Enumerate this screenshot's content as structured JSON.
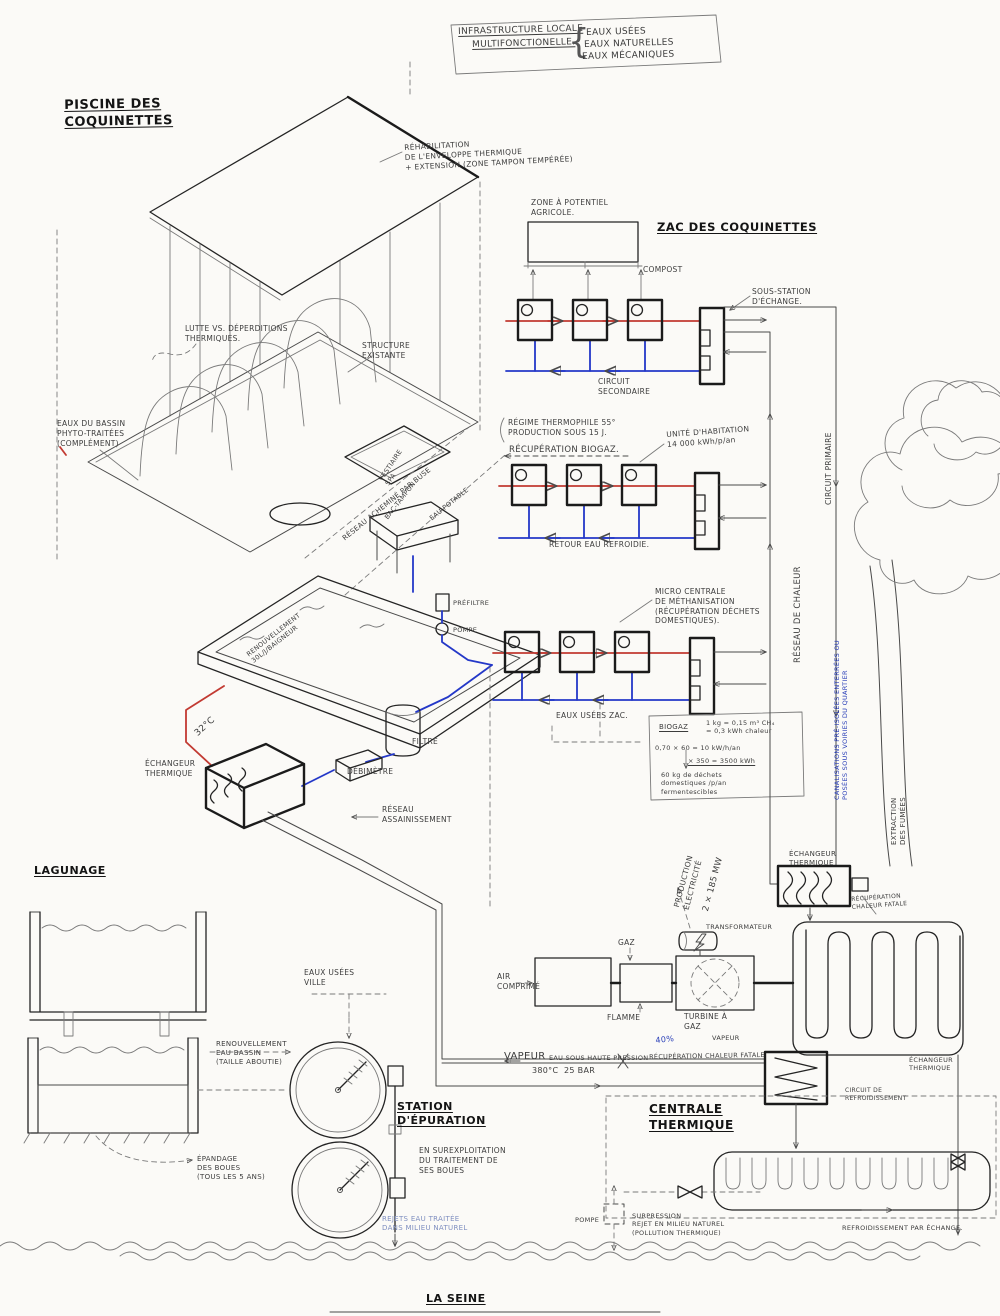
{
  "meta": {
    "description": "Hand-drawn infrastructure diagram: local multifunctional water/heat network around the Coquinettes pool, ZAC housing, thermal power plant, sewage treatment and the Seine river",
    "palette": {
      "paper": "#fbfaf7",
      "ink": "#3c3c3c",
      "marker": "#141414",
      "red_pipe": "#c23a32",
      "blue_pipe": "#2438c8"
    }
  },
  "labels": [
    {
      "n": "title-line1",
      "t": "INFRASTRUCTURE LOCALE",
      "x": 458,
      "y": 27,
      "s": 9,
      "u": 1,
      "r": -1.5
    },
    {
      "n": "title-line2",
      "t": "MULTIFONCTIONELLE.",
      "x": 472,
      "y": 40,
      "s": 9,
      "u": 1,
      "r": -1.5
    },
    {
      "n": "title-brace",
      "t": "{",
      "x": 568,
      "y": 20,
      "s": 34,
      "c": "#555555"
    },
    {
      "n": "title-item-eaux-usees",
      "t": "EAUX USÉES",
      "x": 586,
      "y": 28,
      "s": 9,
      "r": -1.5
    },
    {
      "n": "title-item-eaux-naturelles",
      "t": "EAUX NATURELLES",
      "x": 584,
      "y": 40,
      "s": 9,
      "r": -1.5
    },
    {
      "n": "title-item-eaux-mecaniques",
      "t": "EAUX MÉCANIQUES",
      "x": 582,
      "y": 52,
      "s": 9,
      "r": -1.5
    },
    {
      "n": "piscine-title",
      "t": "PISCINE DES\nCOQUINETTES",
      "x": 64,
      "y": 98,
      "s": 13,
      "b": 1,
      "u": 1,
      "r": -1
    },
    {
      "n": "rehab-note",
      "t": "RÉHABILITATION\nDE L'ENVELOPPE THERMIQUE\n+ EXTENSION (ZONE TAMPON TEMPÉRÉE)",
      "x": 404,
      "y": 143,
      "s": 7.5,
      "r": -3
    },
    {
      "n": "zone-agricole",
      "t": "ZONE À POTENTIEL\nAGRICOLE.",
      "x": 531,
      "y": 198,
      "s": 7.5
    },
    {
      "n": "zac-title",
      "t": "ZAC DES COQUINETTES",
      "x": 657,
      "y": 220,
      "s": 11.5,
      "b": 1,
      "u": 1
    },
    {
      "n": "compost",
      "t": "COMPOST",
      "x": 643,
      "y": 265,
      "s": 7.5
    },
    {
      "n": "sous-station",
      "t": "SOUS-STATION\nD'ÉCHANGE.",
      "x": 752,
      "y": 287,
      "s": 7.5
    },
    {
      "n": "lutte-deperditions",
      "t": "LUTTE VS. DÉPERDITIONS\nTHERMIQUES.",
      "x": 185,
      "y": 324,
      "s": 7.5
    },
    {
      "n": "structure-existante",
      "t": "STRUCTURE\nEXISTANTE",
      "x": 362,
      "y": 341,
      "s": 7.5
    },
    {
      "n": "circuit-secondaire",
      "t": "CIRCUIT\nSECONDAIRE",
      "x": 598,
      "y": 377,
      "s": 7.5
    },
    {
      "n": "eaux-bassin",
      "t": "EAUX DU BASSIN\nPHYTO-TRAITÉES\n(COMPLÉMENT)",
      "x": 57,
      "y": 419,
      "s": 7.5
    },
    {
      "n": "regime-thermophile",
      "t": "RÉGIME THERMOPHILE 55°\nPRODUCTION SOUS 15 J.",
      "x": 508,
      "y": 418,
      "s": 7.5
    },
    {
      "n": "recuperation-biogaz",
      "t": "RÉCUPÉRATION BIOGAZ.",
      "x": 509,
      "y": 445,
      "s": 8.5
    },
    {
      "n": "unite-habitation",
      "t": "UNITÉ D'HABITATION\n14 000 kWh/p/an",
      "x": 666,
      "y": 430,
      "s": 7.5,
      "r": -4
    },
    {
      "n": "vestiaire-spa",
      "t": "VESTIAIRE\nSPA",
      "x": 377,
      "y": 478,
      "s": 6.5,
      "r": -56
    },
    {
      "n": "reseau-buse",
      "t": "RÉSEAU ACHEMINÉ PAR BUSE",
      "x": 341,
      "y": 536,
      "s": 7,
      "r": -39
    },
    {
      "n": "bac-tampon",
      "t": "BAC-TAMPON",
      "x": 383,
      "y": 516,
      "s": 6.5,
      "r": -52
    },
    {
      "n": "eau-potable",
      "t": "EAU POTABLE",
      "x": 428,
      "y": 516,
      "s": 6.5,
      "r": -39
    },
    {
      "n": "retour-eau-refroidie",
      "t": "RETOUR EAU REFROIDIE.",
      "x": 549,
      "y": 540,
      "s": 7.5
    },
    {
      "n": "micro-centrale",
      "t": "MICRO CENTRALE\nDE MÉTHANISATION\n(RÉCUPÉRATION DÉCHETS\nDOMESTIQUES).",
      "x": 655,
      "y": 587,
      "s": 7.5
    },
    {
      "n": "reseau-de-chaleur",
      "t": "RÉSEAU DE CHALEUR",
      "x": 793,
      "y": 663,
      "s": 8.5,
      "r": -90
    },
    {
      "n": "circuit-primaire",
      "t": "CIRCUIT PRIMAIRE",
      "x": 824,
      "y": 505,
      "s": 7.5,
      "r": -90
    },
    {
      "n": "canalisations",
      "t": "CANALISATIONS PRÉ-ISOLÉES ENTERRÉES OU\nPOSÉES SOUS VOIRIES DU QUARTIER",
      "x": 833,
      "y": 800,
      "s": 6.5,
      "r": -90,
      "c": "#2a3fb8"
    },
    {
      "n": "prefiltre",
      "t": "PRÉFILTRE",
      "x": 453,
      "y": 599,
      "s": 6.5
    },
    {
      "n": "pompe-piscine",
      "t": "POMPE",
      "x": 453,
      "y": 626,
      "s": 6.5
    },
    {
      "n": "renouvellement-baigneur",
      "t": "RENOUVELLEMENT\n30L/J/BAIGNEUR",
      "x": 245,
      "y": 652,
      "s": 6.5,
      "r": -38
    },
    {
      "n": "temp-32",
      "t": "32°C",
      "x": 193,
      "y": 731,
      "s": 9,
      "r": -42
    },
    {
      "n": "echangeur-thermique-piscine",
      "t": "ÉCHANGEUR\nTHERMIQUE",
      "x": 145,
      "y": 759,
      "s": 7.5
    },
    {
      "n": "filtre",
      "t": "FILTRE",
      "x": 412,
      "y": 737,
      "s": 7.5
    },
    {
      "n": "debimetre",
      "t": "DÉBIMÈTRE",
      "x": 347,
      "y": 767,
      "s": 7.5
    },
    {
      "n": "reseau-assainissement",
      "t": "RÉSEAU\nASSAINISSEMENT",
      "x": 382,
      "y": 805,
      "s": 7.5
    },
    {
      "n": "eaux-usees-zac",
      "t": "EAUX USÉES ZAC.",
      "x": 556,
      "y": 711,
      "s": 7.5
    },
    {
      "n": "biogaz-titre",
      "t": "BIOGAZ",
      "x": 659,
      "y": 723,
      "s": 7,
      "u": 1
    },
    {
      "n": "biogaz-equiv",
      "t": "1 kg = 0,15 m³ CH₄\n= 0,3 kWh chaleur",
      "x": 706,
      "y": 719,
      "s": 6.5
    },
    {
      "n": "biogaz-calc1",
      "t": "0,70 × 60 = 10 kW/h/an",
      "x": 655,
      "y": 744,
      "s": 6.5
    },
    {
      "n": "biogaz-calc2",
      "t": "× 350 = 3500 kWh",
      "x": 688,
      "y": 757,
      "s": 6.5,
      "u": 1
    },
    {
      "n": "biogaz-dechets",
      "t": "60 kg de déchets\ndomestiques /p/an\nfermentescibles",
      "x": 661,
      "y": 771,
      "s": 6.5
    },
    {
      "n": "production-electricite",
      "t": "PRODUCTION\nÉLECTRICITÉ",
      "x": 672,
      "y": 906,
      "s": 7.5,
      "r": -75
    },
    {
      "n": "puissance-mw",
      "t": "2 × 185 MW",
      "x": 701,
      "y": 910,
      "s": 8.5,
      "r": -75
    },
    {
      "n": "transformateur",
      "t": "TRANSFORMATEUR",
      "x": 706,
      "y": 923,
      "s": 6.5
    },
    {
      "n": "gaz",
      "t": "GAZ",
      "x": 618,
      "y": 938,
      "s": 7.5
    },
    {
      "n": "air-comprime",
      "t": "AIR\nCOMPRIMÉ",
      "x": 497,
      "y": 972,
      "s": 7.5
    },
    {
      "n": "flamme",
      "t": "FLAMME",
      "x": 607,
      "y": 1013,
      "s": 7.5
    },
    {
      "n": "turbine-a-gaz",
      "t": "TURBINE À\nGAZ",
      "x": 684,
      "y": 1012,
      "s": 7.5
    },
    {
      "n": "echangeur-thermique-reseau",
      "t": "ÉCHANGEUR\nTHERMIQUE",
      "x": 789,
      "y": 850,
      "s": 7
    },
    {
      "n": "recuperation-fatale-haut",
      "t": "RÉCUPÉRATION\nCHALEUR FATALE",
      "x": 851,
      "y": 896,
      "s": 6,
      "r": -4
    },
    {
      "n": "extraction-fumees",
      "t": "EXTRACTION\nDES FUMÉES",
      "x": 890,
      "y": 845,
      "s": 7,
      "r": -90
    },
    {
      "n": "vapeur",
      "t": "VAPEUR",
      "x": 504,
      "y": 1050,
      "s": 10
    },
    {
      "n": "eau-haute-pression",
      "t": "EAU SOUS HAUTE PRESSION",
      "x": 549,
      "y": 1054,
      "s": 6.5
    },
    {
      "n": "temp-380",
      "t": "380°C  25 BAR",
      "x": 532,
      "y": 1066,
      "s": 8
    },
    {
      "n": "pourcent-40",
      "t": "40%",
      "x": 655,
      "y": 1036,
      "s": 8,
      "c": "#2a3fb8",
      "r": -6
    },
    {
      "n": "recuperation-fatale-bas",
      "t": "RÉCUPÉRATION CHALEUR FATALE",
      "x": 649,
      "y": 1053,
      "s": 6.5,
      "r": -1
    },
    {
      "n": "vapeur-petit",
      "t": "VAPEUR",
      "x": 712,
      "y": 1034,
      "s": 6.5
    },
    {
      "n": "echangeur-thermique-vapeur",
      "t": "ÉCHANGEUR\nTHERMIQUE",
      "x": 909,
      "y": 1056,
      "s": 6.5
    },
    {
      "n": "circuit-refroidissement",
      "t": "CIRCUIT DE\nREFROIDISSEMENT",
      "x": 845,
      "y": 1087,
      "s": 6
    },
    {
      "n": "centrale-thermique",
      "t": "CENTRALE\nTHERMIQUE",
      "x": 649,
      "y": 1102,
      "s": 12,
      "b": 1,
      "u": 1
    },
    {
      "n": "station-epuration",
      "t": "STATION\nD'ÉPURATION",
      "x": 397,
      "y": 1100,
      "s": 11,
      "b": 1,
      "u": 1
    },
    {
      "n": "surexploitation",
      "t": "EN SUREXPLOITATION\nDU TRAITEMENT DE\nSES BOUES",
      "x": 419,
      "y": 1146,
      "s": 7.5
    },
    {
      "n": "lagunage",
      "t": "LAGUNAGE",
      "x": 34,
      "y": 864,
      "s": 11,
      "b": 1,
      "u": 1
    },
    {
      "n": "eaux-usees-ville",
      "t": "EAUX USÉES\nVILLE",
      "x": 304,
      "y": 968,
      "s": 7.5
    },
    {
      "n": "renouvellement-bassin",
      "t": "RENOUVELLEMENT\nEAU BASSIN\n(TAILLE ABOUTIE)",
      "x": 216,
      "y": 1040,
      "s": 7
    },
    {
      "n": "epandage-boues",
      "t": "ÉPANDAGE\nDES BOUES\n(TOUS LES 5 ANS)",
      "x": 197,
      "y": 1155,
      "s": 7
    },
    {
      "n": "rejets-eau-traitee",
      "t": "REJETS EAU TRAITÉE\nDANS MILIEU NATUREL",
      "x": 382,
      "y": 1215,
      "s": 7,
      "c": "#7f8fc0"
    },
    {
      "n": "pompe-rejet",
      "t": "POMPE",
      "x": 575,
      "y": 1216,
      "s": 6.5
    },
    {
      "n": "surpression",
      "t": "SURPRESSION\nREJET EN MILIEU NATUREL\n(POLLUTION THERMIQUE)",
      "x": 632,
      "y": 1212,
      "s": 6.5
    },
    {
      "n": "refroidissement-echange",
      "t": "REFROIDISSEMENT PAR ÉCHANGE.",
      "x": 842,
      "y": 1224,
      "s": 6.5
    },
    {
      "n": "la-seine",
      "t": "LA SEINE",
      "x": 426,
      "y": 1292,
      "s": 11,
      "b": 1,
      "u": 1
    }
  ]
}
